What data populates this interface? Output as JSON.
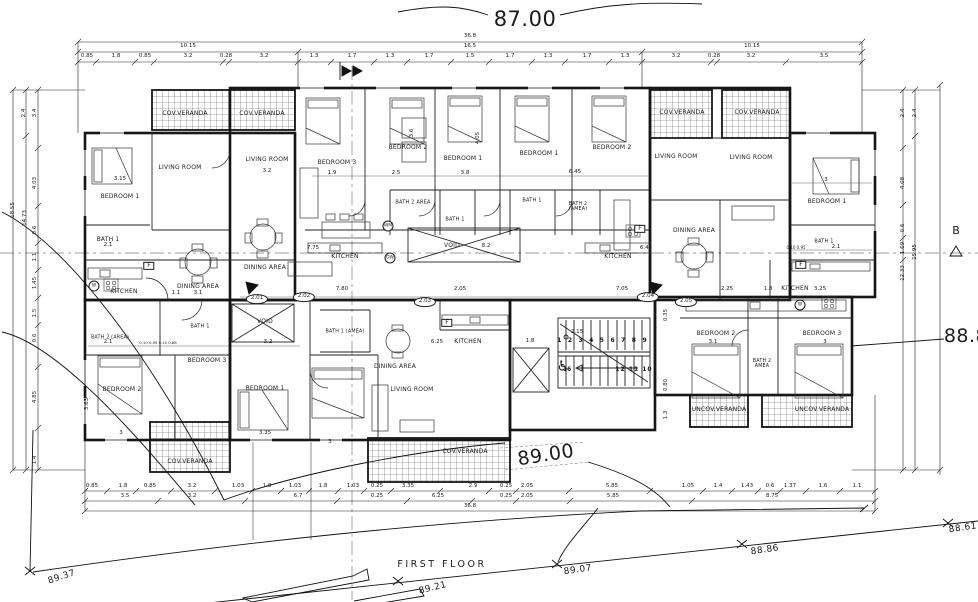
{
  "title": {
    "floor_label": "FIRST  FLOOR"
  },
  "section_marker_b": "B",
  "accessibility_symbol": "♿",
  "stairs": {
    "top_run": "1 2 3 4 5 6 7 8 9",
    "mid": "16",
    "bottom_run": "12 11 10"
  },
  "rooms": [
    {
      "t": "COV.VERANDA",
      "x": 185,
      "y": 114
    },
    {
      "t": "COV.VERANDA",
      "x": 262,
      "y": 114
    },
    {
      "t": "LIVING ROOM",
      "x": 180,
      "y": 168
    },
    {
      "t": "LIVING ROOM",
      "x": 267,
      "y": 160
    },
    {
      "t": "BEDROOM 1",
      "x": 120,
      "y": 197
    },
    {
      "t": "BATH 1",
      "x": 108,
      "y": 240
    },
    {
      "t": "KITCHEN",
      "x": 124,
      "y": 292
    },
    {
      "t": "DINING AREA",
      "x": 198,
      "y": 287
    },
    {
      "t": "DINING AREA",
      "x": 265,
      "y": 268
    },
    {
      "t": "BEDROOM 3",
      "x": 337,
      "y": 163
    },
    {
      "t": "BEDROOM 2",
      "x": 408,
      "y": 148
    },
    {
      "t": "BEDROOM 1",
      "x": 463,
      "y": 159
    },
    {
      "t": "BEDROOM 1",
      "x": 539,
      "y": 154
    },
    {
      "t": "BEDROOM 2",
      "x": 612,
      "y": 148
    },
    {
      "t": "BATH 2 AREA",
      "x": 413,
      "y": 203,
      "fs": 5
    },
    {
      "t": "BATH 1",
      "x": 455,
      "y": 220,
      "fs": 5
    },
    {
      "t": "KITCHEN",
      "x": 345,
      "y": 257
    },
    {
      "t": "VOID",
      "x": 452,
      "y": 246
    },
    {
      "t": "BATH 1",
      "x": 532,
      "y": 201,
      "fs": 5
    },
    {
      "t": "BATH 2 (AMEA)",
      "x": 578,
      "y": 207,
      "fs": 4.8,
      "w": 30
    },
    {
      "t": "COV.VERANDA",
      "x": 682,
      "y": 113
    },
    {
      "t": "COV.VERANDA",
      "x": 757,
      "y": 113
    },
    {
      "t": "LIVING ROOM",
      "x": 676,
      "y": 157
    },
    {
      "t": "LIVING ROOM",
      "x": 751,
      "y": 158
    },
    {
      "t": "DINING AREA",
      "x": 694,
      "y": 231
    },
    {
      "t": "KITCHEN",
      "x": 618,
      "y": 257
    },
    {
      "t": "KITCHEN",
      "x": 795,
      "y": 289
    },
    {
      "t": "BEDROOM 1",
      "x": 827,
      "y": 202
    },
    {
      "t": "BATH 1",
      "x": 824,
      "y": 242,
      "fs": 5
    },
    {
      "t": "VOID",
      "x": 265,
      "y": 322
    },
    {
      "t": "BATH 2 (AREA)",
      "x": 110,
      "y": 338,
      "fs": 4.8
    },
    {
      "t": "BATH 1",
      "x": 200,
      "y": 327,
      "fs": 5
    },
    {
      "t": "BEDROOM 2",
      "x": 122,
      "y": 390
    },
    {
      "t": "BEDROOM 3",
      "x": 207,
      "y": 361
    },
    {
      "t": "BEDROOM 1",
      "x": 265,
      "y": 389
    },
    {
      "t": "BATH 1 (AMEA)",
      "x": 345,
      "y": 332,
      "fs": 4.8
    },
    {
      "t": "DINING AREA",
      "x": 395,
      "y": 367
    },
    {
      "t": "KITCHEN",
      "x": 468,
      "y": 342
    },
    {
      "t": "LIVING ROOM",
      "x": 412,
      "y": 390
    },
    {
      "t": "COV.VERANDA",
      "x": 190,
      "y": 462
    },
    {
      "t": "COV.VERANDA",
      "x": 465,
      "y": 452
    },
    {
      "t": "BEDROOM 2",
      "x": 716,
      "y": 334
    },
    {
      "t": "BEDROOM 3",
      "x": 822,
      "y": 334
    },
    {
      "t": "BATH 2 AMEA",
      "x": 762,
      "y": 364,
      "fs": 4.8,
      "w": 28
    },
    {
      "t": "UNCOV.VERANDA",
      "x": 719,
      "y": 410
    },
    {
      "t": "UNCOV.VERANDA",
      "x": 822,
      "y": 410
    }
  ],
  "dims": [
    {
      "t": "36.8",
      "x": 470,
      "y": 37
    },
    {
      "t": "10.15",
      "x": 188,
      "y": 47
    },
    {
      "t": "16.5",
      "x": 470,
      "y": 47
    },
    {
      "t": "10.15",
      "x": 752,
      "y": 47
    },
    {
      "t": "0.85",
      "x": 87,
      "y": 57
    },
    {
      "t": "1.8",
      "x": 116,
      "y": 57
    },
    {
      "t": "0.85",
      "x": 145,
      "y": 57
    },
    {
      "t": "3.2",
      "x": 188,
      "y": 57
    },
    {
      "t": "0.28",
      "x": 226,
      "y": 57
    },
    {
      "t": "3.2",
      "x": 264,
      "y": 57
    },
    {
      "t": "1.3",
      "x": 314,
      "y": 57
    },
    {
      "t": "1.7",
      "x": 352,
      "y": 57
    },
    {
      "t": "1.3",
      "x": 390,
      "y": 57
    },
    {
      "t": "1.7",
      "x": 429,
      "y": 57
    },
    {
      "t": "1.5",
      "x": 470,
      "y": 57
    },
    {
      "t": "1.7",
      "x": 510,
      "y": 57
    },
    {
      "t": "1.3",
      "x": 548,
      "y": 57
    },
    {
      "t": "1.7",
      "x": 587,
      "y": 57
    },
    {
      "t": "1.3",
      "x": 625,
      "y": 57
    },
    {
      "t": "3.2",
      "x": 676,
      "y": 57
    },
    {
      "t": "0.28",
      "x": 714,
      "y": 57
    },
    {
      "t": "3.2",
      "x": 751,
      "y": 57
    },
    {
      "t": "3.5",
      "x": 824,
      "y": 57
    },
    {
      "t": "0.85",
      "x": 92,
      "y": 487
    },
    {
      "t": "1.8",
      "x": 123,
      "y": 487
    },
    {
      "t": "0.85",
      "x": 150,
      "y": 487
    },
    {
      "t": "3.2",
      "x": 192,
      "y": 487
    },
    {
      "t": "1.03",
      "x": 238,
      "y": 487
    },
    {
      "t": "1.8",
      "x": 267,
      "y": 487
    },
    {
      "t": "1.03",
      "x": 295,
      "y": 487
    },
    {
      "t": "1.8",
      "x": 323,
      "y": 487
    },
    {
      "t": "1.03",
      "x": 353,
      "y": 487
    },
    {
      "t": "0.25",
      "x": 377,
      "y": 487
    },
    {
      "t": "3.35",
      "x": 408,
      "y": 487
    },
    {
      "t": "2.9",
      "x": 473,
      "y": 487
    },
    {
      "t": "0.25",
      "x": 506,
      "y": 487
    },
    {
      "t": "2.05",
      "x": 527,
      "y": 487
    },
    {
      "t": "5.85",
      "x": 612,
      "y": 487
    },
    {
      "t": "1.05",
      "x": 688,
      "y": 487
    },
    {
      "t": "1.4",
      "x": 718,
      "y": 487
    },
    {
      "t": "1.43",
      "x": 747,
      "y": 487
    },
    {
      "t": "0.6",
      "x": 770,
      "y": 487
    },
    {
      "t": "1.37",
      "x": 790,
      "y": 487
    },
    {
      "t": "1.6",
      "x": 823,
      "y": 487
    },
    {
      "t": "1.1",
      "x": 857,
      "y": 487
    },
    {
      "t": "3.5",
      "x": 125,
      "y": 497
    },
    {
      "t": "3.2",
      "x": 192,
      "y": 497
    },
    {
      "t": "6.7",
      "x": 298,
      "y": 497
    },
    {
      "t": "0.25",
      "x": 377,
      "y": 497
    },
    {
      "t": "6.25",
      "x": 438,
      "y": 497
    },
    {
      "t": "0.25",
      "x": 506,
      "y": 497
    },
    {
      "t": "2.05",
      "x": 527,
      "y": 497
    },
    {
      "t": "5.85",
      "x": 613,
      "y": 497
    },
    {
      "t": "8.75",
      "x": 772,
      "y": 497
    },
    {
      "t": "36.8",
      "x": 470,
      "y": 507
    },
    {
      "t": "2.4",
      "x": 25,
      "y": 113,
      "r": -90
    },
    {
      "t": "3.4",
      "x": 36,
      "y": 113,
      "r": -90
    },
    {
      "t": "4.03",
      "x": 36,
      "y": 183,
      "r": -90
    },
    {
      "t": "0.6",
      "x": 36,
      "y": 230,
      "r": -90
    },
    {
      "t": "1.1",
      "x": 36,
      "y": 257,
      "r": -90
    },
    {
      "t": "1.45",
      "x": 36,
      "y": 283,
      "r": -90
    },
    {
      "t": "1.5",
      "x": 36,
      "y": 313,
      "r": -90
    },
    {
      "t": "0.6",
      "x": 36,
      "y": 338,
      "r": -90
    },
    {
      "t": "4.85",
      "x": 36,
      "y": 397,
      "r": -90
    },
    {
      "t": "1.4",
      "x": 36,
      "y": 460,
      "r": -90
    },
    {
      "t": "18.55",
      "x": 14,
      "y": 210,
      "r": -90
    },
    {
      "t": "14.73",
      "x": 26,
      "y": 218,
      "r": -90
    },
    {
      "t": "2.4",
      "x": 904,
      "y": 113,
      "r": -90
    },
    {
      "t": "2.4",
      "x": 916,
      "y": 113,
      "r": -90
    },
    {
      "t": "4.08",
      "x": 904,
      "y": 183,
      "r": -90
    },
    {
      "t": "0.6",
      "x": 904,
      "y": 228,
      "r": -90
    },
    {
      "t": "1.69",
      "x": 904,
      "y": 248,
      "r": -90
    },
    {
      "t": "15.95",
      "x": 916,
      "y": 252,
      "r": -90
    },
    {
      "t": "12.33",
      "x": 904,
      "y": 273,
      "r": -90
    },
    {
      "t": "3.15",
      "x": 120,
      "y": 180
    },
    {
      "t": "3.2",
      "x": 267,
      "y": 172
    },
    {
      "t": "2.1",
      "x": 108,
      "y": 246
    },
    {
      "t": "3.1",
      "x": 198,
      "y": 294
    },
    {
      "t": "1.1",
      "x": 176,
      "y": 294
    },
    {
      "t": "1.9",
      "x": 332,
      "y": 174
    },
    {
      "t": "2.5",
      "x": 396,
      "y": 174
    },
    {
      "t": "3.8",
      "x": 465,
      "y": 174
    },
    {
      "t": "3.6",
      "x": 413,
      "y": 133,
      "r": -90
    },
    {
      "t": "4.05",
      "x": 479,
      "y": 138,
      "r": -90
    },
    {
      "t": "7.75",
      "x": 313,
      "y": 249
    },
    {
      "t": "8.2",
      "x": 486,
      "y": 247
    },
    {
      "t": "6.45",
      "x": 575,
      "y": 173
    },
    {
      "t": "6.45",
      "x": 646,
      "y": 249
    },
    {
      "t": "3",
      "x": 826,
      "y": 181
    },
    {
      "t": "2.1",
      "x": 836,
      "y": 248
    },
    {
      "t": "0.10 0.95",
      "x": 796,
      "y": 248,
      "fs": 4
    },
    {
      "t": "7.80",
      "x": 342,
      "y": 290
    },
    {
      "t": "2.05",
      "x": 460,
      "y": 290
    },
    {
      "t": "7.05",
      "x": 622,
      "y": 290
    },
    {
      "t": "2.25",
      "x": 727,
      "y": 290
    },
    {
      "t": "1.8",
      "x": 768,
      "y": 290
    },
    {
      "t": "3.25",
      "x": 820,
      "y": 290
    },
    {
      "t": "2.1",
      "x": 108,
      "y": 343
    },
    {
      "t": "0.10 0.95 0.10 0.88",
      "x": 158,
      "y": 343,
      "fs": 3.8
    },
    {
      "t": "3.2",
      "x": 268,
      "y": 343
    },
    {
      "t": "3.63",
      "x": 88,
      "y": 404,
      "r": -90
    },
    {
      "t": "3",
      "x": 121,
      "y": 434
    },
    {
      "t": "3.35",
      "x": 265,
      "y": 434
    },
    {
      "t": "3",
      "x": 330,
      "y": 443
    },
    {
      "t": "6.25",
      "x": 437,
      "y": 343
    },
    {
      "t": "3.1",
      "x": 713,
      "y": 343
    },
    {
      "t": "3",
      "x": 825,
      "y": 343
    },
    {
      "t": "2.15",
      "x": 577,
      "y": 333
    },
    {
      "t": "1.8",
      "x": 530,
      "y": 342
    },
    {
      "t": "0.35",
      "x": 667,
      "y": 315,
      "r": -90
    },
    {
      "t": "0.80",
      "x": 667,
      "y": 385,
      "r": -90
    },
    {
      "t": "1.3",
      "x": 667,
      "y": 415,
      "r": -90
    }
  ],
  "units": [
    {
      "t": "2.01",
      "x": 257,
      "y": 299
    },
    {
      "t": "2.02",
      "x": 304,
      "y": 297
    },
    {
      "t": "2.03",
      "x": 425,
      "y": 302
    },
    {
      "t": "2.04",
      "x": 648,
      "y": 297
    },
    {
      "t": "2.05",
      "x": 686,
      "y": 302
    }
  ],
  "levels": [
    {
      "t": "87.00",
      "x": 525,
      "y": 19,
      "fs": 21
    },
    {
      "t": "89.00",
      "x": 546,
      "y": 456,
      "fs": 19,
      "r": -9
    },
    {
      "t": "88.8",
      "x": 966,
      "y": 337,
      "fs": 19
    },
    {
      "t": "89.37",
      "x": 62,
      "y": 578,
      "fs": 9,
      "r": -18
    },
    {
      "t": "89.21",
      "x": 433,
      "y": 589,
      "fs": 9,
      "r": -14
    },
    {
      "t": "89.07",
      "x": 578,
      "y": 571,
      "fs": 9,
      "r": -8
    },
    {
      "t": "88.86",
      "x": 765,
      "y": 551,
      "fs": 9,
      "r": -8
    },
    {
      "t": "88.61",
      "x": 963,
      "y": 529,
      "fs": 9,
      "r": -8
    }
  ],
  "fixtures_box": [
    {
      "t": "F",
      "x": 149,
      "y": 266
    },
    {
      "t": "F",
      "x": 640,
      "y": 229
    },
    {
      "t": "F",
      "x": 801,
      "y": 265
    },
    {
      "t": "F",
      "x": 447,
      "y": 323
    }
  ],
  "fixtures_circle": [
    {
      "t": "W",
      "x": 94,
      "y": 286
    },
    {
      "t": "WM",
      "x": 388,
      "y": 226
    },
    {
      "t": "OW",
      "x": 390,
      "y": 258
    },
    {
      "t": "W",
      "x": 800,
      "y": 305
    }
  ]
}
